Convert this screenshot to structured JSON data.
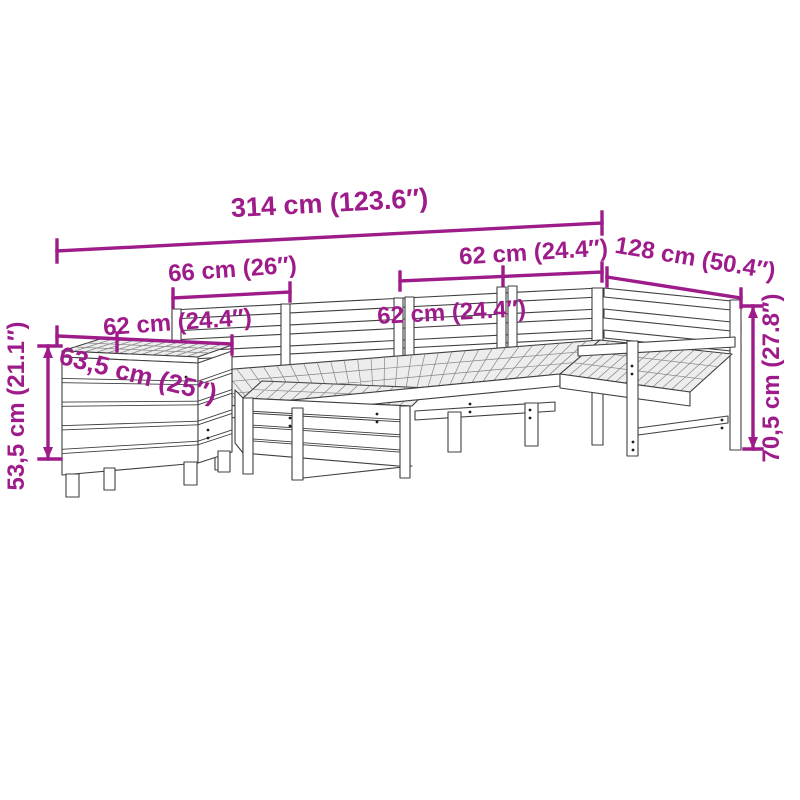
{
  "colors": {
    "dimension_accent": "#9e1b8a",
    "drawing_outline": "#3f3f3f",
    "background": "#ffffff"
  },
  "dimensions": {
    "overall_width": "314 cm (123.6″)",
    "left_section_width": "66 cm (26″)",
    "right_back_section_width": "62 cm (24.4″)",
    "right_side_depth": "128 cm (50.4″)",
    "middle_section_width": "62 cm (24.4″)",
    "box_width": "62 cm (24.4″)",
    "box_depth": "63,5 cm (25″)",
    "box_height": "53,5 cm (21.1″)",
    "sofa_height": "70,5 cm (27.8″)"
  }
}
